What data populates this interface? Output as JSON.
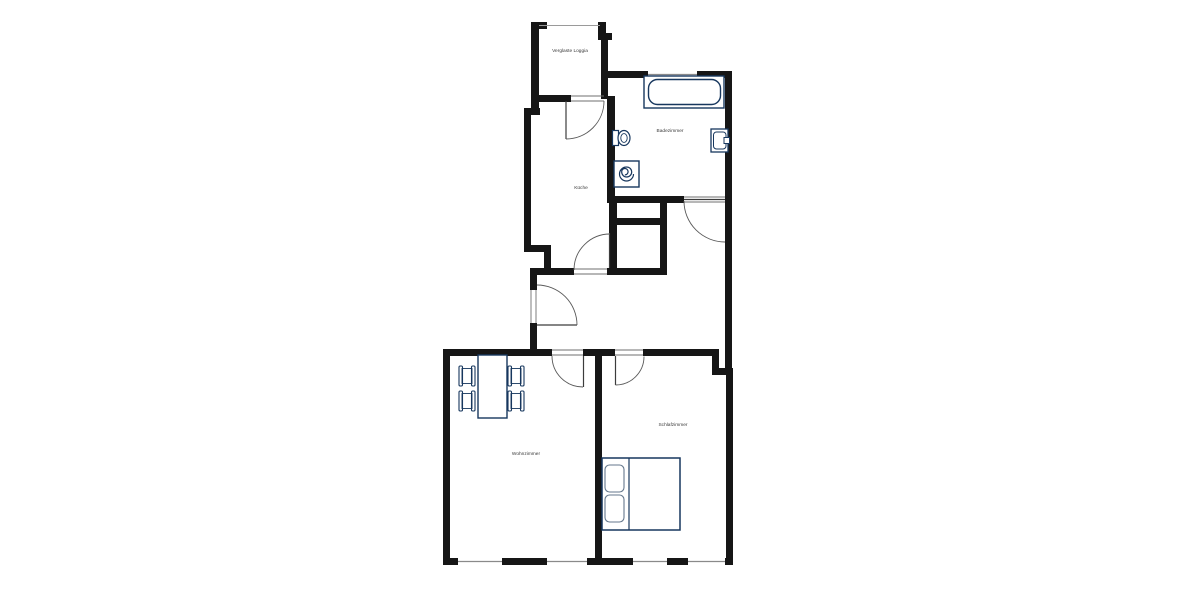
{
  "plan": {
    "background_color": "#ffffff",
    "wall_color": "#161616",
    "furniture_color": "#17375e",
    "rooms": [
      {
        "id": "loggia",
        "label": "Verglaste Loggia"
      },
      {
        "id": "badezimmer",
        "label": "Badezimmer"
      },
      {
        "id": "kueche",
        "label": "Küche"
      },
      {
        "id": "schlafzimmer",
        "label": "Schlafzimmer"
      },
      {
        "id": "wohnzimmer",
        "label": "Wohnzimmer"
      }
    ],
    "furniture": [
      "bathtub",
      "toilet",
      "sink",
      "washing-machine",
      "dining-table",
      "chair",
      "chair",
      "chair",
      "chair",
      "double-bed",
      "pillow",
      "pillow"
    ]
  }
}
